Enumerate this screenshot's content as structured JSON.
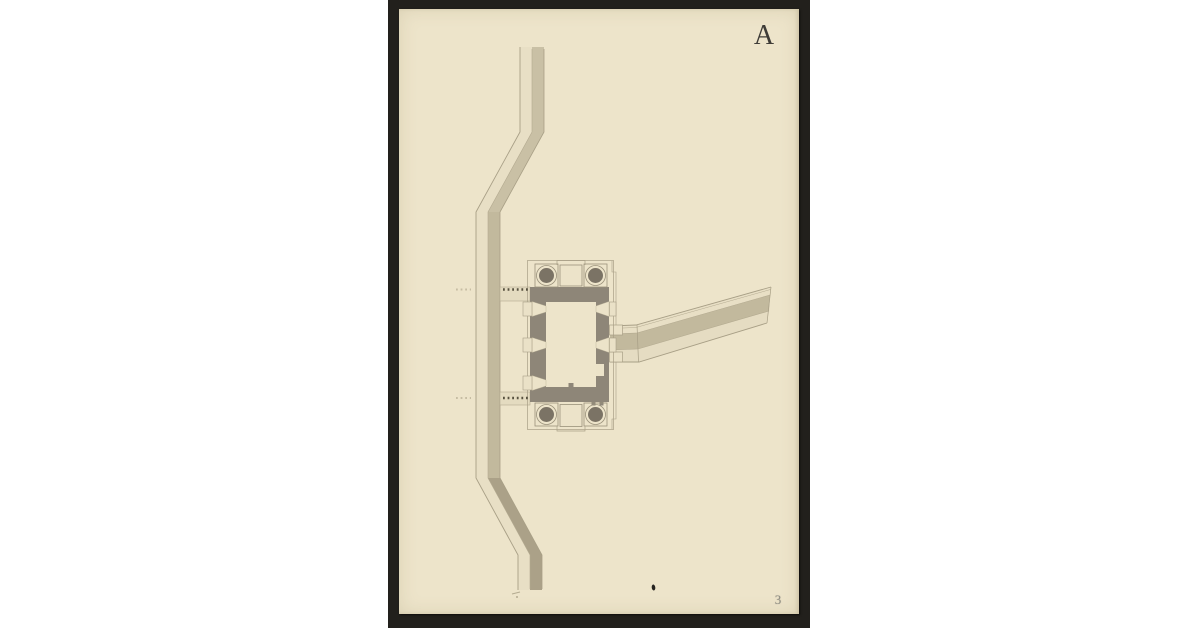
{
  "document": {
    "plate_letter": "A",
    "page_number": "3",
    "kind": "scanned architectural plan of a fortified gatehouse with ramparts"
  },
  "colors": {
    "background": "#ffffff",
    "mat": "#22201c",
    "paper": "#ede4ca",
    "drawing_line": "#a89f86",
    "drawing_line_dark": "#8c8370",
    "wall_fill_dark": "#8e8678",
    "tower_fill": "#7b7365",
    "wash_light": "#c9c0a5",
    "wash_mid": "#c2b99d",
    "wash_dark": "#aba188",
    "band_light": "#e8dfc5",
    "band_light2": "#e5dcc2",
    "connector_fill": "#e4dbc0",
    "embrasure_fill": "#eae1c7",
    "courtyard_fill": "#ece3c9",
    "dot_ink": "#57513f",
    "dot_faint": "#a79e85",
    "plate_letter_color": "#3e3c37",
    "page_number_color": "#8f8d82",
    "ink_blot": "#262420"
  }
}
